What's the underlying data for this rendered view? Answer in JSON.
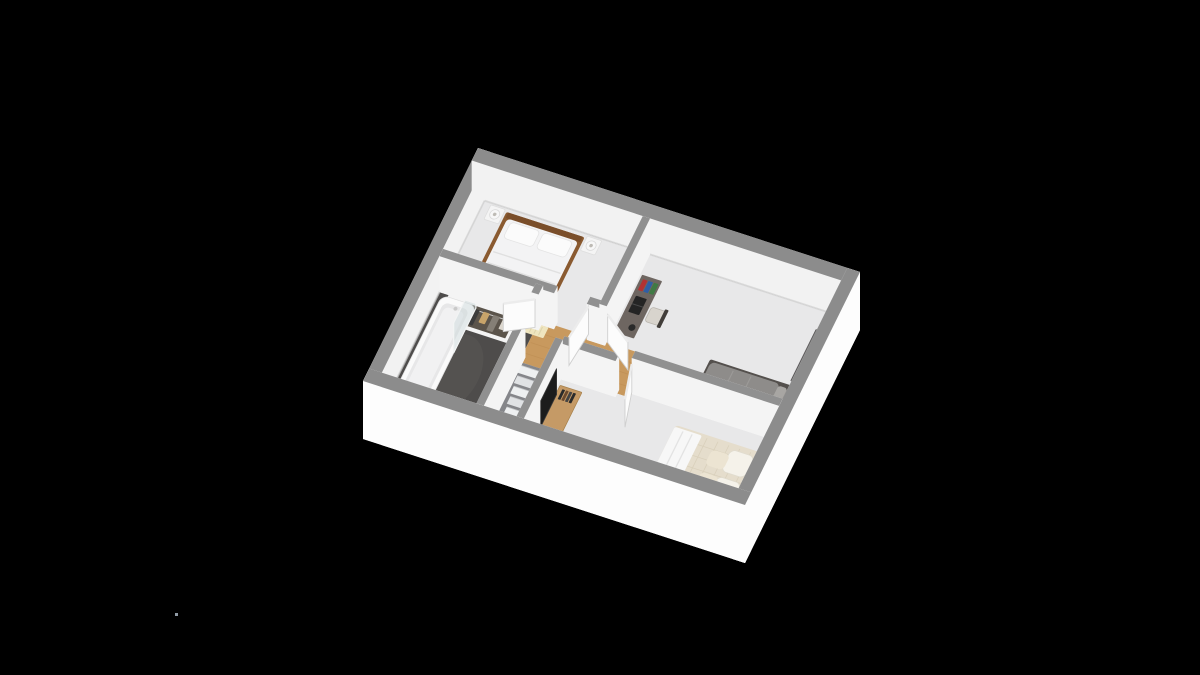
{
  "scene": {
    "title": "3d-floor-plan-upper-storey",
    "canvas": {
      "width": 1200,
      "height": 675,
      "background": "#000000"
    },
    "projection": {
      "ox": 478,
      "oy": 148,
      "ux": 0.9095,
      "uy": 0.2952,
      "vx": -0.4423,
      "vy": 0.8962,
      "wall_height_px": 36,
      "near_wall_height_px": 58,
      "door_height_px": 28
    },
    "palette": {
      "wall_cap": "#8c8c8c",
      "wall_cap_inner": "#909090",
      "wall_face": "#f2f2f2",
      "interior_face": "#f4f4f4",
      "near_wall_face": "#fdfdfd",
      "floor": "#e8e8e9",
      "floor_shade": "#d9d9db",
      "bathroom_floor": "#4e4c4b",
      "bathroom_floor_patch": "#5a5855",
      "wood_floor": "#c8995e",
      "wood_plank_line": "#b9894e",
      "stair_tread": "#eef0f1",
      "stair_tread_alt": "#e0e2e4",
      "stair_well": "#85868a",
      "door_leaf": "#fcfcfc",
      "door_edge": "#cfcfcf",
      "door_top": "#ececec",
      "glass": "#c9d6da",
      "tv": "#1c1c1c"
    },
    "rooms": [
      {
        "name": "bedroom-1"
      },
      {
        "name": "bedroom-2"
      },
      {
        "name": "bedroom-3"
      },
      {
        "name": "bathroom"
      },
      {
        "name": "hallway-landing"
      },
      {
        "name": "staircase"
      }
    ],
    "building": {
      "width_units": 420,
      "depth_units": 260,
      "outer_wall_units": 14
    },
    "walls_far": [
      {
        "name": "outer-wall-top-left",
        "rect": [
          0,
          0,
          14,
          260
        ]
      },
      {
        "name": "outer-wall-top-right",
        "rect": [
          0,
          0,
          420,
          14
        ]
      }
    ],
    "walls_interior": [
      {
        "name": "wall-bedroom1-bottom",
        "rect": [
          14,
          108,
          140,
          116
        ]
      },
      {
        "name": "wall-bedroom1-doorpost",
        "rect": [
          176,
          108,
          196,
          116
        ]
      },
      {
        "name": "wall-bedroom1-bedroom2",
        "rect": [
          188,
          14,
          196,
          112
        ]
      },
      {
        "name": "wall-landing-bedroom3",
        "rect": [
          170,
          154,
          230,
          162
        ]
      },
      {
        "name": "wall-bedroom2-bedroom3",
        "rect": [
          244,
          146,
          406,
          154
        ]
      },
      {
        "name": "wall-bathroom-doorpost",
        "rect": [
          118,
          112,
          126,
          122
        ]
      },
      {
        "name": "wall-bathroom-stairs",
        "rect": [
          118,
          152,
          126,
          246
        ]
      },
      {
        "name": "wall-stair-half",
        "rect": [
          162,
          158,
          170,
          246
        ]
      }
    ],
    "walls_near": [
      {
        "name": "outer-wall-bottom-right",
        "rect": [
          406,
          0,
          420,
          260
        ]
      },
      {
        "name": "outer-wall-bottom-left",
        "rect": [
          0,
          246,
          420,
          260
        ]
      }
    ],
    "floors": [
      {
        "name": "floor-main",
        "rect": [
          14,
          14,
          406,
          246
        ],
        "fill": "#e8e8e9"
      },
      {
        "name": "floor-bathroom",
        "rect": [
          14,
          112,
          122,
          246
        ],
        "fill": "#4e4c4b"
      },
      {
        "name": "floor-landing-wood",
        "rect": [
          122,
          112,
          238,
          158
        ],
        "fill": "#c8995e"
      },
      {
        "name": "floor-doorway-wood",
        "rect": [
          230,
          146,
          244,
          158
        ],
        "fill": "#c8995e"
      }
    ],
    "stairs": {
      "name": "staircase",
      "well": [
        122,
        158,
        162,
        246
      ],
      "tread_u": [
        124,
        160
      ],
      "tread_depth": 8,
      "count": 11,
      "drop_px": 3.2
    },
    "doors": [
      {
        "name": "door-bedroom-1",
        "hinge": [
          176,
          112
        ],
        "end": [
          172,
          148
        ]
      },
      {
        "name": "door-bedroom-2",
        "hinge": [
          198,
          114
        ],
        "end": [
          230,
          134
        ]
      },
      {
        "name": "door-bathroom",
        "hinge": [
          122,
          122
        ],
        "end": [
          94,
          136
        ]
      },
      {
        "name": "door-bedroom-3",
        "hinge": [
          244,
          154
        ],
        "end": [
          254,
          190
        ]
      }
    ],
    "glass_screen": {
      "name": "shower-screen",
      "a": [
        56,
        120
      ],
      "b": [
        56,
        170
      ],
      "h": 30
    },
    "tv": {
      "name": "tv-panel",
      "a": [
        173,
        178
      ],
      "b": [
        173,
        214
      ],
      "h": 26
    },
    "furniture": [
      {
        "kind": "nightstand",
        "name": "nightstand-bedroom1-left",
        "rect": [
          22,
          16,
          38,
          32
        ],
        "fill": "#f4f4f4",
        "lamp": "#f7f7f7"
      },
      {
        "kind": "nightstand",
        "name": "nightstand-bedroom1-right",
        "rect": [
          128,
          16,
          144,
          32
        ],
        "fill": "#f4f4f4",
        "lamp": "#f7f7f7"
      },
      {
        "kind": "bed_double_white",
        "name": "bed-bedroom1",
        "rect": [
          40,
          18,
          126,
          106
        ],
        "frame": "#8a5a30",
        "headboard": "#7a4e2a",
        "duvet": "#f3f3f4",
        "pillow": "#fbfbfb"
      },
      {
        "kind": "cabinet",
        "name": "bookcase-bedroom1",
        "rect": [
          176,
          62,
          188,
          104
        ],
        "fill": "#e2cfa3",
        "books": [
          "#b23232",
          "#2f5fa5",
          "#3f7a44"
        ]
      },
      {
        "kind": "closet",
        "name": "open-wardrobe-bathroom",
        "rect": [
          26,
          116,
          100,
          142
        ],
        "frame": "#f4f4f4",
        "interior": "#5b544b",
        "clothes": [
          "#b23232",
          "#ececec",
          "#3c3c3c",
          "#c8a46a",
          "#857f76",
          "#ddd8cf"
        ]
      },
      {
        "kind": "radiator",
        "name": "radiator-bathroom",
        "rect": [
          104,
          116,
          134,
          128
        ],
        "fill": "#efe5bf",
        "rib": "#ded5ad"
      },
      {
        "kind": "tub",
        "name": "bathtub",
        "rect": [
          18,
          118,
          56,
          238
        ],
        "fill": "#fafafa",
        "inner": "#e7e7e8",
        "faucet": "#c9c9c9"
      },
      {
        "kind": "sinks",
        "name": "double-sink",
        "rects": [
          [
            102,
            170,
            118,
            196
          ],
          [
            102,
            200,
            118,
            226
          ]
        ],
        "fill": "#f7f7f7",
        "bowl": "#e3e3e3"
      },
      {
        "kind": "desk",
        "name": "desk-bedroom2",
        "rect": [
          198,
          36,
          220,
          100
        ],
        "fill": "#6e6661",
        "laptop": "#242424",
        "books": [
          "#b23232",
          "#2f5fa5",
          "#3f7a44"
        ],
        "lamp": "#2a2a2a"
      },
      {
        "kind": "chair",
        "name": "desk-chair-bedroom2",
        "seat": [
          222,
          64,
          238,
          80
        ],
        "back": [
          236,
          62,
          240,
          82
        ],
        "seat_fill": "#d8d4cd",
        "back_fill": "#413d39"
      },
      {
        "kind": "bed_single",
        "name": "bed-bedroom2",
        "rect": [
          302,
          96,
          392,
          142
        ],
        "base": "#54504d",
        "duvet": "#8e8c8a",
        "pillow": "#a8a6a3"
      },
      {
        "kind": "dresser",
        "name": "dresser-bedroom2",
        "rect": [
          388,
          34,
          406,
          92
        ],
        "fill": "#5d5b5c",
        "basket": "#c9a063",
        "books": [
          "#b23232",
          "#2f5fa5",
          "#e0dcd4"
        ]
      },
      {
        "kind": "floor_lamp",
        "name": "lamp-bedroom2",
        "center": [
          396,
          136
        ],
        "fill": "#f0ede6",
        "core": "#b9b6af"
      },
      {
        "kind": "tvstand",
        "name": "tv-stand-bedroom3",
        "rect": [
          172,
          168,
          196,
          232
        ],
        "fill": "#c59a66",
        "books": [
          "#2b2b2b",
          "#6b4a2f",
          "#444444",
          "#2b2b2b"
        ]
      },
      {
        "kind": "nightstand_dark",
        "name": "nightstand-bedroom3-left",
        "rect": [
          390,
          154,
          404,
          168
        ],
        "fill": "#2f2d2b",
        "lamp": "#c6bfb4"
      },
      {
        "kind": "bed_double_cream",
        "name": "bed-bedroom3",
        "rect": [
          300,
          170,
          398,
          236
        ],
        "headboard": [
          398,
          166,
          406,
          240
        ],
        "frame": "#34312e",
        "duvet": "#e5ddcc",
        "quilt_line": "#d9d0bb",
        "throw": "#f7f7f7",
        "pillow_a": "#f5f2ea",
        "pillow_b": "#ece4d2"
      },
      {
        "kind": "nightstand_dark",
        "name": "nightstand-bedroom3-right",
        "rect": [
          390,
          238,
          404,
          252
        ],
        "fill": "#2f2d2b",
        "lamp": "#c6bfb4"
      }
    ],
    "artifact_dot": {
      "x": 175,
      "y": 613,
      "size": 3,
      "color": "#a9b6c2"
    }
  }
}
